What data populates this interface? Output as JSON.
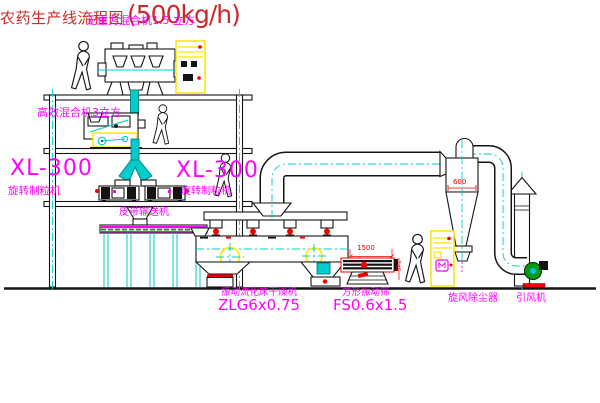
{
  "title": {
    "name": "农药生产线流程图",
    "capacity": "(500kg/h)"
  },
  "labels": {
    "mixer_top": "无重力混合机1.5 立方",
    "mixer_mid": "高效混合机3立方",
    "granulator_model_left": "XL-300",
    "granulator_name_left": "旋转制粒机",
    "granulator_model_right": "XL-300",
    "granulator_name_right": "旋转制粒机",
    "belt_conveyor": "皮带输送机",
    "dryer_name": "振动流化床干燥机",
    "dryer_model": "ZLG6x0.75",
    "sieve_name": "方形振动筛",
    "sieve_model": "FS0.6x1.5",
    "cyclone_name": "旋风除尘器",
    "fan_name": "引风机"
  },
  "dimensions": {
    "cyclone_width": "600",
    "sieve_length": "1500",
    "sieve_height": "745"
  },
  "colors": {
    "line": "#141414",
    "magenta": "#ff00ff",
    "red": "#f20000",
    "title": "#cc2a2a",
    "cyan": "#00cccc",
    "yellow": "#ffe400",
    "green": "#00a000",
    "bg": "#ffffff"
  }
}
